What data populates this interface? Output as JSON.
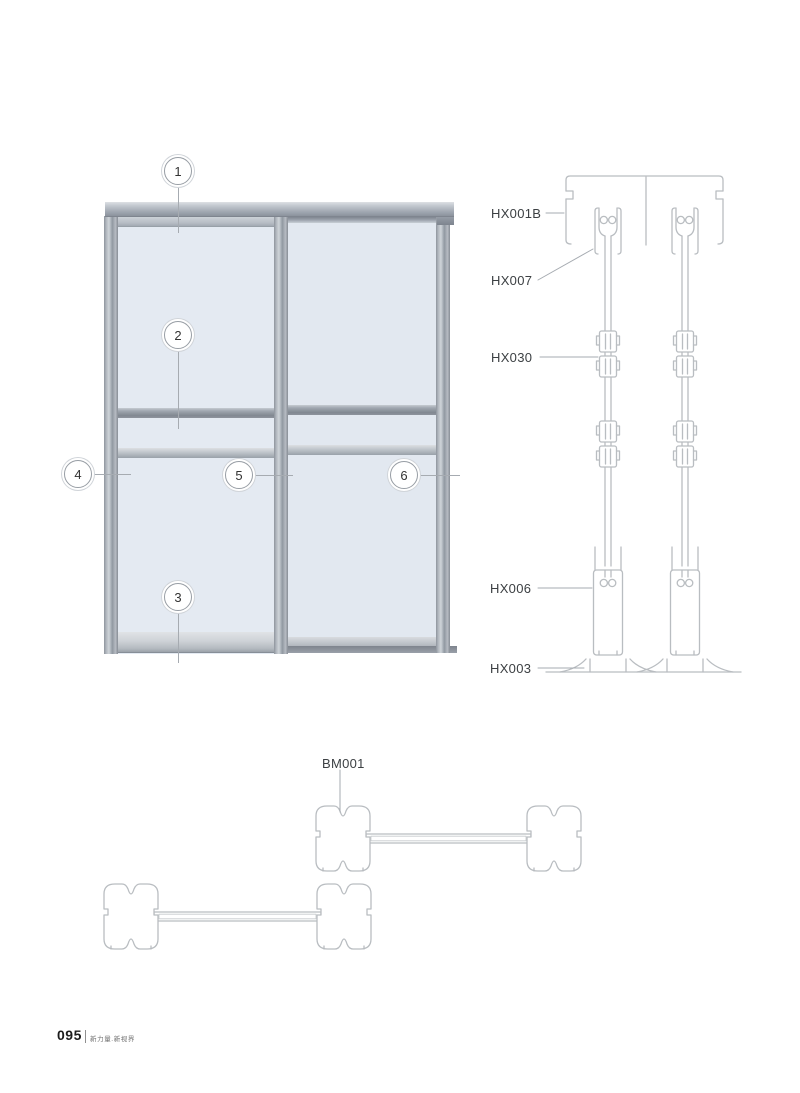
{
  "footer": {
    "page_number": "095",
    "tagline": "新力量.新视界"
  },
  "elevation": {
    "callouts": [
      {
        "label": "1"
      },
      {
        "label": "2"
      },
      {
        "label": "3"
      },
      {
        "label": "4"
      },
      {
        "label": "5"
      },
      {
        "label": "6"
      }
    ]
  },
  "vertical_section": {
    "labels": [
      {
        "code": "HX001B"
      },
      {
        "code": "HX007"
      },
      {
        "code": "HX030"
      },
      {
        "code": "HX006"
      },
      {
        "code": "HX003"
      }
    ]
  },
  "horizontal_section": {
    "labels": [
      {
        "code": "BM001"
      }
    ]
  },
  "colors": {
    "drawing_line": "#b9bdc1",
    "label_text": "#3c4043",
    "callout_ring": "#979da4",
    "panel_fill": "#e4eaf2",
    "frame_dark": "#848a93",
    "frame_light": "#cfd4da"
  }
}
